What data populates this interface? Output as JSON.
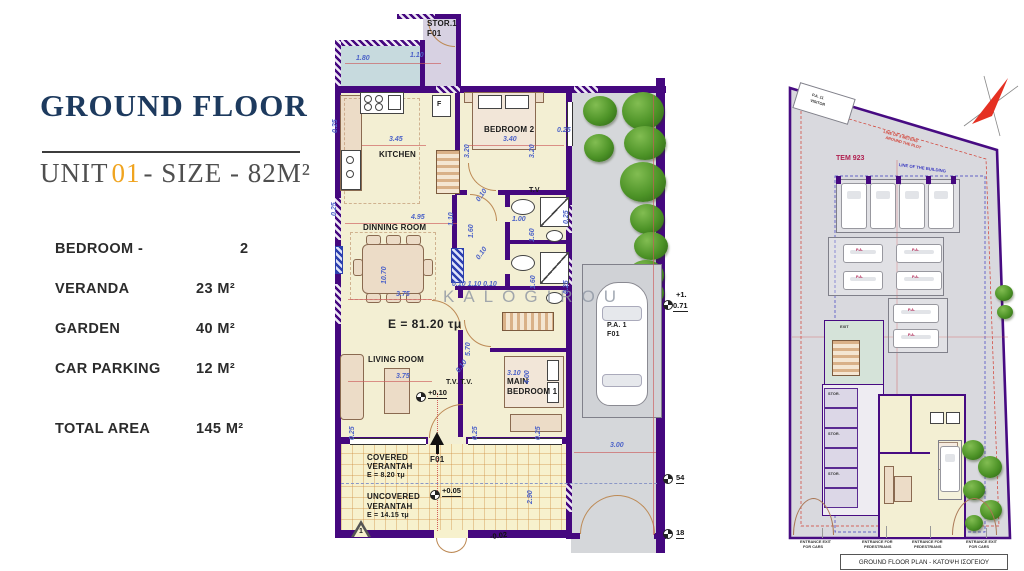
{
  "left_panel": {
    "title": "GROUND FLOOR",
    "unit_prefix": "UNIT",
    "unit_number": "01",
    "unit_suffix": "- SIZE - 82M²",
    "specs": [
      {
        "label": "BEDROOM -",
        "value": "2"
      },
      {
        "label": "VERANDA",
        "value": "23 M²"
      },
      {
        "label": "GARDEN",
        "value": "40 M²"
      },
      {
        "label": "CAR PARKING",
        "value": "12 M²"
      },
      {
        "label": "TOTAL AREA",
        "value": "145 M²"
      }
    ]
  },
  "floor_plan": {
    "watermark": "KALOGIROU",
    "storage_name": "STOR.1",
    "storage_code": "F01",
    "rooms": {
      "kitchen": "KITCHEN",
      "bedroom2": "BEDROOM 2",
      "dining": "DINNING ROOM",
      "living": "LIVING ROOM",
      "main_bedroom_1": "MAIN",
      "main_bedroom_2": "BEDROOM 1",
      "fridge": "F",
      "tv": "T.V",
      "tv_tv": "T.V. T.V."
    },
    "areas": {
      "total": "E = 81.20 τμ",
      "covered_1": "COVERED",
      "covered_2": "VERANTAH",
      "covered_area": "E = 8.20 τμ",
      "uncovered_1": "UNCOVERED",
      "uncovered_2": "VERANTAH",
      "uncovered_area": "E = 14.15 τμ"
    },
    "parking_label_1": "P.A. 1",
    "parking_label_2": "F01",
    "entrance_code": "F01",
    "plan_marker": "1",
    "levels": {
      "p010": "+0.10",
      "p005": "+0.05",
      "m002": "-0.02",
      "p1": "+1.",
      "v071": "0.71",
      "v54": "54",
      "v18": "18"
    },
    "dims": {
      "d180": "1.80",
      "d110": "1.10",
      "d025": "0.25",
      "d345": "3.45",
      "d320": "3.20",
      "d340": "3.40",
      "d495": "4.95",
      "d160": "1.60",
      "d010": "0.10",
      "d100": "1.00",
      "d375": "3.75",
      "d1070": "10.70",
      "d570": "5.70",
      "d310": "3.10",
      "d400": "4.00",
      "d290": "2.90",
      "d300": "3.00",
      "combo": "0.10 1.10 0.10"
    }
  },
  "site_plan": {
    "visitor_1": "P.A. 11",
    "visitor_2": "VISITOR",
    "tem": "TEM 923",
    "plot_note_1": "LINE OF 3 METERS",
    "plot_note_2": "AROUND THE PLOT",
    "building_note": "LINE OF THE BUILDING",
    "exit": "EXIT",
    "stall": "P.A.",
    "storage": "STOR.",
    "entrance_cars_1": "ENTRANCE EXIT",
    "entrance_cars_2": "FOR CARS",
    "entrance_ped_1": "ENTRANCE FOR",
    "entrance_ped_2": "PEDESTRIANS",
    "title": "GROUND FLOOR PLAN - ΚΑΤΟΨΗ ΙΣΟΓΕΙΟΥ"
  }
}
